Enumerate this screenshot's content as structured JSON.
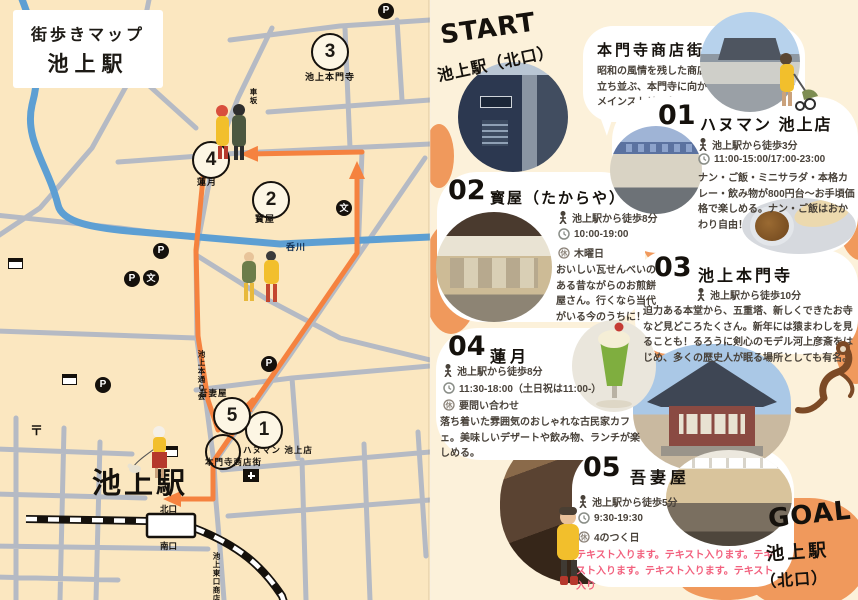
{
  "map": {
    "title1": "街歩きマップ",
    "title2": "池上駅",
    "station": "池上駅",
    "north_exit": "北口",
    "south_exit": "南口",
    "river": "呑川",
    "labels": {
      "honmonji": "池上本門寺",
      "rengetsu": "蓮月",
      "takaraya": "寳屋",
      "azumaya": "吾妻屋",
      "hanuman": "ハヌマン 池上店",
      "shotengai": "本門寺商店街",
      "kurumazaka": "車坂",
      "hondori": "池上本通り会",
      "higashiguchi": "池上東口商店街"
    },
    "markers": [
      "1",
      "2",
      "3",
      "4",
      "5"
    ],
    "icons": {
      "parking": "P",
      "school": "文",
      "post": "〒"
    }
  },
  "start": {
    "label": "START",
    "station": "池上駅（北口）"
  },
  "goal": {
    "label": "GOAL",
    "station": "池上駅",
    "exit": "（北口）"
  },
  "intro": {
    "title": "本門寺商店街",
    "desc": "昭和の風情を残した商店が立ち並ぶ、本門寺に向かうメインストリート。"
  },
  "stops": [
    {
      "num": "01",
      "name": "ハヌマン 池上店",
      "walk": "池上駅から徒歩3分",
      "hours": "11:00-15:00/17:00-23:00",
      "desc": "ナン・ご飯・ミニサラダ・本格カレー・飲み物が800円台〜お手頃価格で楽しめる。ナン・ご飯はおかわり自由！"
    },
    {
      "num": "02",
      "name": "寳屋（たからや）",
      "walk": "池上駅から徒歩8分",
      "hours": "10:00-19:00",
      "closed": "木曜日",
      "desc": "おいしい瓦せんべいのある昔ながらのお煎餅屋さん。行くなら当代がいる今のうちに！"
    },
    {
      "num": "03",
      "name": "池上本門寺",
      "walk": "池上駅から徒歩10分",
      "desc": "迫力ある本堂から、五重塔、新しくできたお寺など見どころたくさん。新年には猿まわしを見ることも！るろうに剣心のモデル河上彦斎をはじめ、多くの歴史人が眠る場所としても有名。"
    },
    {
      "num": "04",
      "name": "蓮月",
      "walk": "池上駅から徒歩8分",
      "hours": "11:30-18:00（土日祝は11:00-）",
      "closed": "要問い合わせ",
      "desc": "落ち着いた雰囲気のおしゃれな古民家カフェ。美味しいデザートや飲み物、ランチが楽しめる。"
    },
    {
      "num": "05",
      "name": "吾妻屋",
      "walk": "池上駅から徒歩5分",
      "hours": "9:30-19:30",
      "closed": "4のつく日",
      "desc": "テキスト入ります。テキスト入ります。テキスト入ります。テキスト入ります。テキスト入り"
    }
  ],
  "icons": {
    "closed": "休"
  },
  "colors": {
    "map_bg": "#FBE7C0",
    "page_bg": "#FCF1DA",
    "street": "#B5BAC4",
    "river": "#5D9FD3",
    "route": "#F5823F",
    "blob": "#F0995C",
    "pink": "#F2617E"
  }
}
